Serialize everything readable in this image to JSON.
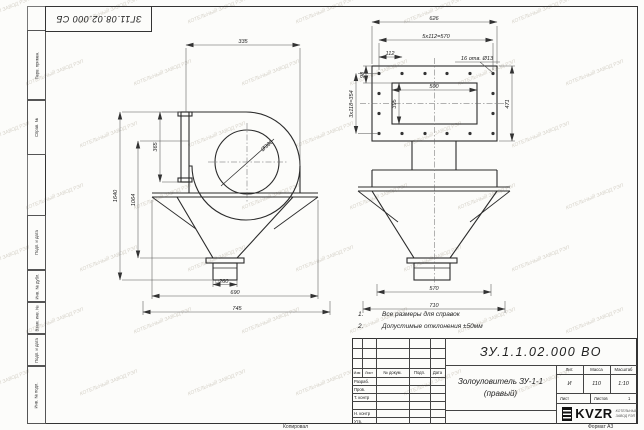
{
  "sheet": {
    "corner_stamp": "ЗГ11.08.02.000 СБ",
    "watermark": "КОТЕЛЬНЫЙ ЗАВОД РЭП",
    "margin_fields": [
      "Перв. примен.",
      "Справ. №",
      "Подп. и дата",
      "Инв. № дубл.",
      "Взам. инв. №",
      "Подп. и дата",
      "Инв. № подл."
    ],
    "footer": {
      "copied": "Копировал",
      "format": "Формат A3"
    }
  },
  "notes": {
    "n1_num": "1.",
    "n1_text": "Все размеры для справок",
    "n2_num": "2.",
    "n2_text": "Допустимые отклонения ±50мм"
  },
  "side_view": {
    "dims": {
      "top_335": "335",
      "flange_365": "365",
      "height_1640": "1640",
      "height_1064": "1064",
      "dia_380": "Ø380",
      "outlet_260": "□260",
      "width_690": "690",
      "width_745": "745"
    }
  },
  "front_view": {
    "dims": {
      "width_626": "626",
      "pitch_570": "5x112=570",
      "pitch_112": "112",
      "holes": "16 отв. Ø13",
      "offset_98": "98",
      "pitch_354": "3x118=354",
      "height_471": "471",
      "inner_500": "500",
      "inner_395": "395",
      "width_570": "570",
      "width_710": "710"
    }
  },
  "title_block": {
    "doc_number": "ЗУ.1.1.02.000 ВО",
    "name_line1": "Золоуловитель ЗУ-1-1",
    "name_line2": "(правый)",
    "columns": {
      "izm": "Изм",
      "list": "Лист",
      "doc": "№ докум.",
      "sign": "Подп.",
      "date": "Дата"
    },
    "rows": {
      "developed": "Разраб.",
      "checked": "Пров.",
      "tcontrol": "Т. контр",
      "ncontrol": "Н. контр",
      "approved": "Утв."
    },
    "lit_label": "Лит.",
    "mass_label": "Масса",
    "scale_label": "Масштаб",
    "lit_value": "И",
    "mass_value": "110",
    "scale_value": "1:10",
    "sheet_label": "Лист",
    "sheets_label": "Листов",
    "sheets_value": "1",
    "logo": {
      "text": "KVZR",
      "sub1": "КОТЕЛЬНЫЙ",
      "sub2": "ЗАВОД РЭП"
    }
  }
}
